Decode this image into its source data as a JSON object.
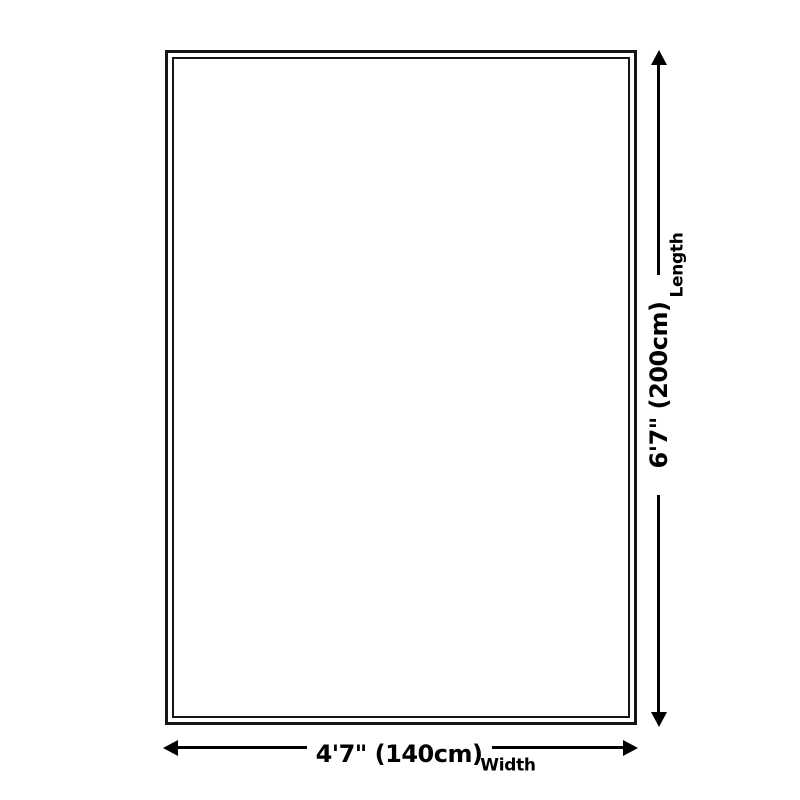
{
  "diagram": {
    "type": "product-dimension-diagram",
    "length": {
      "value": "6'7\" (200cm)",
      "label": "Length"
    },
    "width": {
      "value": "4'7\" (140cm)",
      "label": "Width"
    },
    "colors": {
      "line": "#000000",
      "outline": "#151515",
      "background": "#ffffff"
    }
  }
}
